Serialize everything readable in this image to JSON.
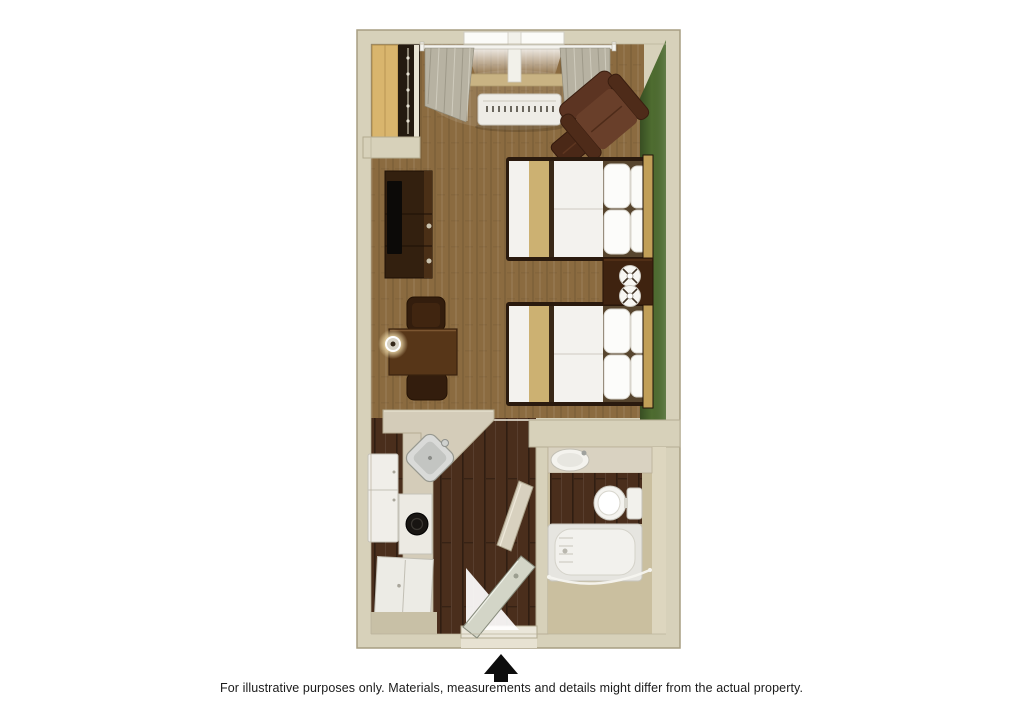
{
  "page": {
    "background_color": "#ffffff",
    "disclaimer": "For illustrative purposes only.  Materials, measurements and details might differ from the actual property."
  },
  "floorplan": {
    "description": "studio-suite-with-two-double-beds-kitchenette-and-bathroom",
    "palette": {
      "wall": "#d7d1ba",
      "wall_edge": "#a79e82",
      "accent_wall_green": "#4e6c30",
      "carpet": "#8b6b40",
      "dark_wood_floor": "#4a2e1c",
      "counter": "#d4ccb9",
      "appliance_white": "#eeece6",
      "bedding_white": "#f3f2ee",
      "bedding_tan": "#ccb172",
      "furniture_dark_brown": "#33200f",
      "armchair_brown": "#5c3422",
      "bathroom_floor": "#cabf9f",
      "closet_wood": "#d9b56d"
    },
    "elements": [
      "closet",
      "window",
      "curtains",
      "air-conditioner",
      "armchair",
      "ottoman",
      "double-bed-1",
      "double-bed-2",
      "nightstand",
      "nightstand-lamps",
      "tv-dresser",
      "television",
      "dining-table",
      "dining-chairs",
      "table-lamp",
      "kitchen-counter",
      "kitchen-sink",
      "refrigerator",
      "stove",
      "kitchen-cabinet",
      "entry-door",
      "bathroom-door",
      "vanity-sink",
      "toilet",
      "bathtub",
      "shower-rod"
    ]
  },
  "entrance": {
    "arrow_icon_color": "#0d0d0d"
  }
}
